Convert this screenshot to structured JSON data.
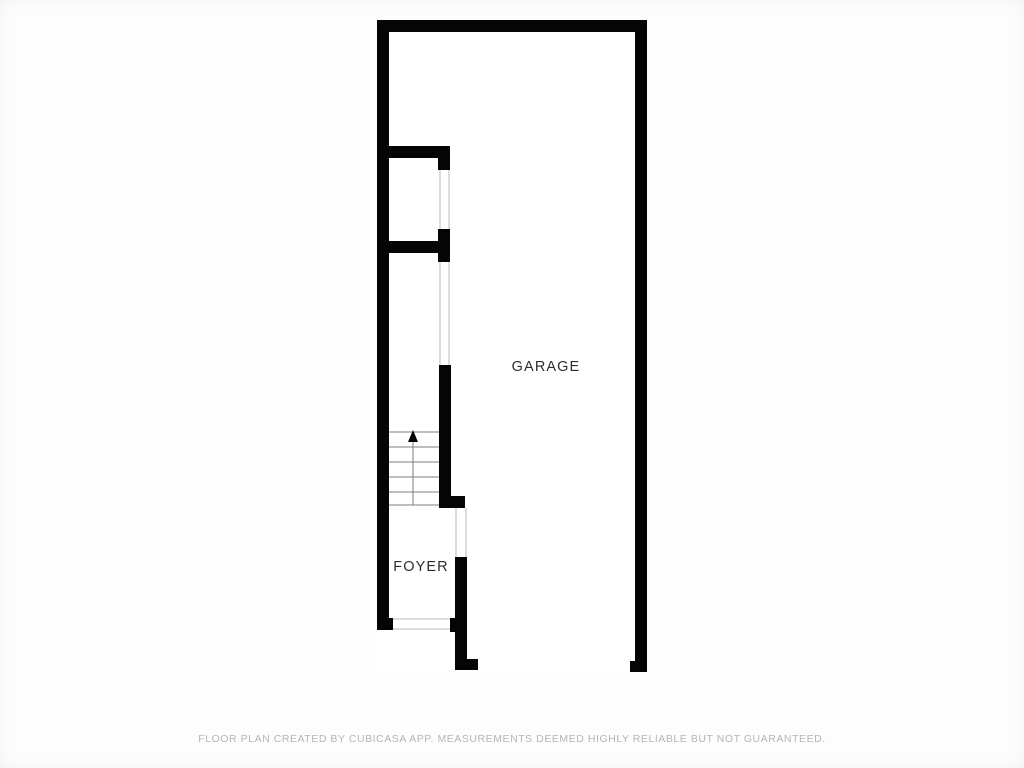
{
  "page": {
    "background": "#fdfdfd",
    "canvas_width": 1024,
    "canvas_height": 768
  },
  "footer": {
    "disclaimer": "FLOOR PLAN CREATED BY CUBICASA APP. MEASUREMENTS DEEMED HIGHLY RELIABLE BUT NOT GUARANTEED.",
    "color": "#b5b5b5"
  },
  "floorplan": {
    "colors": {
      "wall": "#050505",
      "interior": "#ffffff",
      "stair_line": "#7d7d7d",
      "opening_line": "#b8b8b8",
      "label": "#2d2d2d"
    },
    "interior": {
      "x": 377,
      "y": 20,
      "w": 270,
      "h": 652
    },
    "walls": [
      {
        "id": "top-wall",
        "x": 377,
        "y": 20,
        "w": 270,
        "h": 12
      },
      {
        "id": "left-wall",
        "x": 377,
        "y": 20,
        "w": 12,
        "h": 610
      },
      {
        "id": "right-wall",
        "x": 635,
        "y": 20,
        "w": 12,
        "h": 652
      },
      {
        "id": "right-wall-foot",
        "x": 630,
        "y": 661,
        "w": 17,
        "h": 11
      },
      {
        "id": "closet-top-wall",
        "x": 377,
        "y": 146,
        "w": 73,
        "h": 12
      },
      {
        "id": "closet-top-stub",
        "x": 438,
        "y": 158,
        "w": 12,
        "h": 12
      },
      {
        "id": "closet-bottom-wall",
        "x": 377,
        "y": 241,
        "w": 73,
        "h": 12
      },
      {
        "id": "closet-stub-upper",
        "x": 438,
        "y": 229,
        "w": 12,
        "h": 12
      },
      {
        "id": "closet-stub-lower",
        "x": 438,
        "y": 253,
        "w": 12,
        "h": 9
      },
      {
        "id": "stairs-side-wall",
        "x": 439,
        "y": 365,
        "w": 12,
        "h": 142
      },
      {
        "id": "stairs-wall-foot",
        "x": 439,
        "y": 496,
        "w": 26,
        "h": 12
      },
      {
        "id": "foyer-right-wall",
        "x": 455,
        "y": 557,
        "w": 12,
        "h": 113
      },
      {
        "id": "foyer-right-foot",
        "x": 455,
        "y": 659,
        "w": 23,
        "h": 11
      },
      {
        "id": "entry-right-tab",
        "x": 450,
        "y": 618,
        "w": 17,
        "h": 14
      },
      {
        "id": "left-wall-foot",
        "x": 377,
        "y": 618,
        "w": 16,
        "h": 12
      }
    ],
    "opening_lines": [
      {
        "id": "closet-door-left",
        "x1": 440,
        "y1": 170,
        "x2": 440,
        "y2": 229
      },
      {
        "id": "closet-door-right",
        "x1": 449,
        "y1": 170,
        "x2": 449,
        "y2": 229
      },
      {
        "id": "passage-left",
        "x1": 440,
        "y1": 262,
        "x2": 440,
        "y2": 365
      },
      {
        "id": "passage-right",
        "x1": 449,
        "y1": 262,
        "x2": 449,
        "y2": 365
      },
      {
        "id": "garage-door-left",
        "x1": 456,
        "y1": 508,
        "x2": 456,
        "y2": 557
      },
      {
        "id": "garage-door-right",
        "x1": 466,
        "y1": 508,
        "x2": 466,
        "y2": 557
      },
      {
        "id": "entry-threshold-top",
        "x1": 393,
        "y1": 619,
        "x2": 450,
        "y2": 619
      },
      {
        "id": "entry-threshold-bot",
        "x1": 393,
        "y1": 629,
        "x2": 450,
        "y2": 629
      }
    ],
    "stairs": {
      "x_left": 389,
      "x_right": 439,
      "treads_y": [
        432,
        447,
        462,
        477,
        492,
        505
      ],
      "center_line": {
        "x": 413,
        "y1": 438,
        "y2": 505
      },
      "arrow": {
        "tip_x": 413,
        "tip_y": 430,
        "half_width": 5,
        "length": 12
      }
    },
    "rooms": [
      {
        "id": "garage",
        "label": "GARAGE",
        "label_x": 546,
        "label_y": 367
      },
      {
        "id": "foyer",
        "label": "FOYER",
        "label_x": 421,
        "label_y": 567
      }
    ]
  }
}
